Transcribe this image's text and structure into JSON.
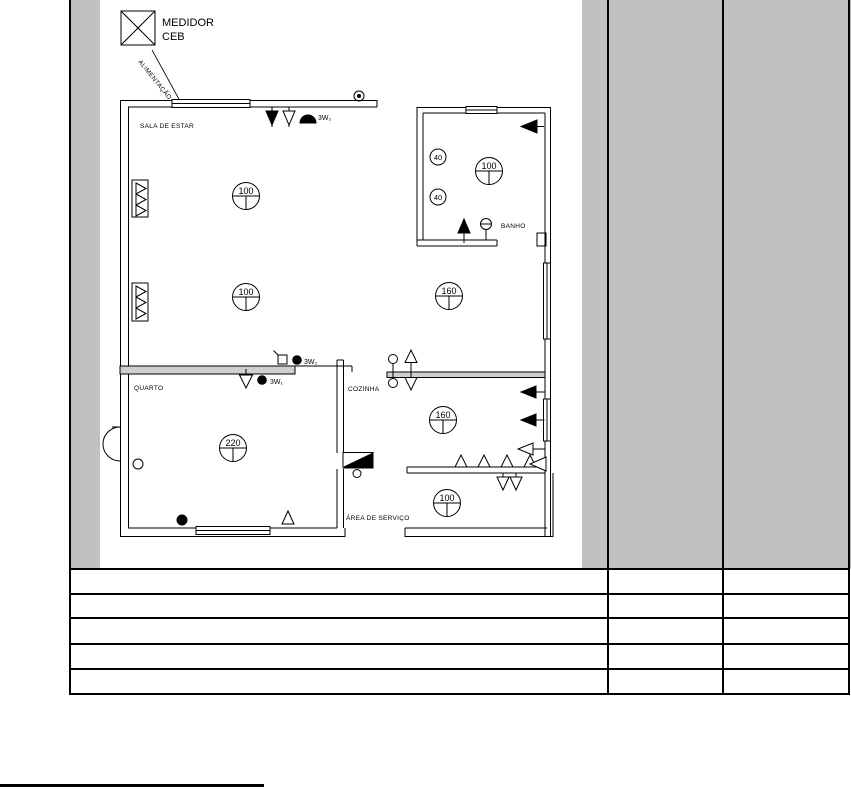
{
  "plan": {
    "meter": {
      "line1": "MEDIDOR",
      "line2": "CEB"
    },
    "feed_label": "ALIMENTAÇÃO",
    "rooms": {
      "living": "SALA DE ESTAR",
      "bath": "BANHO",
      "bedroom": "QUARTO",
      "kitchen": "COZINHA",
      "service": "ÁREA DE SERVIÇO"
    },
    "lights": {
      "living1": "100",
      "living2": "100",
      "hall": "160",
      "bath": "100",
      "sconce1": "40",
      "sconce2": "40",
      "bedroom": "220",
      "kitchen": "160",
      "service": "100"
    },
    "switches": {
      "living_pair": "3W₂",
      "bedroom_pair_a": "3W₂",
      "bedroom_pair_b": "3W₁"
    }
  },
  "table": {
    "row_count": 5,
    "column_count": 3
  },
  "colors": {
    "band": "#c1c1c1",
    "wall": "#cfcfcf",
    "ink": "#000000"
  }
}
